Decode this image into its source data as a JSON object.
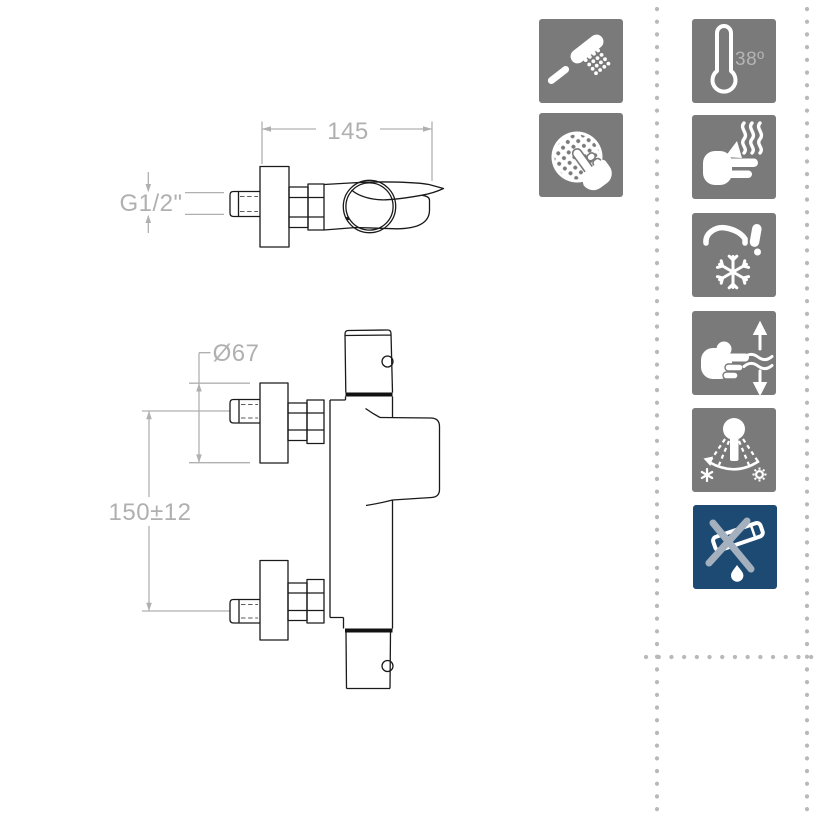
{
  "drawing": {
    "top_view": {
      "width_dim": "145",
      "thread_dim": "G1/2\""
    },
    "front_view": {
      "flange_diameter_dim": "Ø67",
      "inlet_distance_dim": "150±12"
    }
  },
  "features": {
    "column_left": [
      {
        "icon": "hand-shower-icon"
      },
      {
        "icon": "touch-spray-clean-icon"
      }
    ],
    "column_right": [
      {
        "icon": "thermostat-38-icon",
        "label": "38º"
      },
      {
        "icon": "anti-scald-hand-heat-icon"
      },
      {
        "icon": "faucet-frost-cold-icon"
      },
      {
        "icon": "hand-flow-adjust-icon"
      },
      {
        "icon": "swivel-spray-icon"
      },
      {
        "icon": "no-drip-crossed-icon"
      }
    ]
  },
  "colors": {
    "icon_gray": "#7a7a7a",
    "icon_blue": "#1d4a72",
    "dimension_gray": "#b0b0b0",
    "drawing_line": "#1a1a1a",
    "dot_gray": "#b9b9b9",
    "cross_gray": "#a4b0bd"
  }
}
